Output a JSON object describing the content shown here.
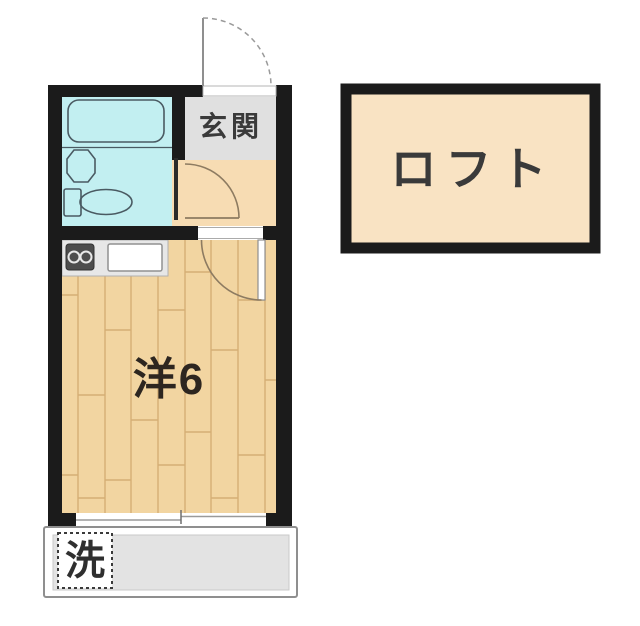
{
  "rooms": {
    "genkan": {
      "label": "玄関"
    },
    "main_room": {
      "label": "洋6"
    },
    "loft": {
      "label": "ロフト"
    }
  },
  "fixtures": {
    "laundry": {
      "label": "洗"
    }
  },
  "icons": {
    "bathtub": "rounded-rect-outline",
    "toilet": "tank-and-bowl-shape",
    "bathroom-sink": "octagon-outline",
    "stove": "two-burner-dark-square",
    "kitchen-sink": "white-rect",
    "door-swing": "quarter-arc",
    "entrance-door-swing": "dashed-quarter-arc",
    "window": "double-line-band"
  },
  "colors": {
    "wall": "#1b1b1b",
    "bathroom": "#c2eff1",
    "genkan": "#e0e0e0",
    "hallway": "#f7dcb3",
    "floor": "#f2d5a1",
    "floor_line": "#c69a5e",
    "loft_fill": "#f9e3c3",
    "counter": "#e7e7e7",
    "balcony": "#e3e3e3",
    "label": "#3a3a3a",
    "fixture_line": "#4a5a62",
    "door_line": "#8d7b61",
    "thin_gray": "#9a9a9a"
  }
}
